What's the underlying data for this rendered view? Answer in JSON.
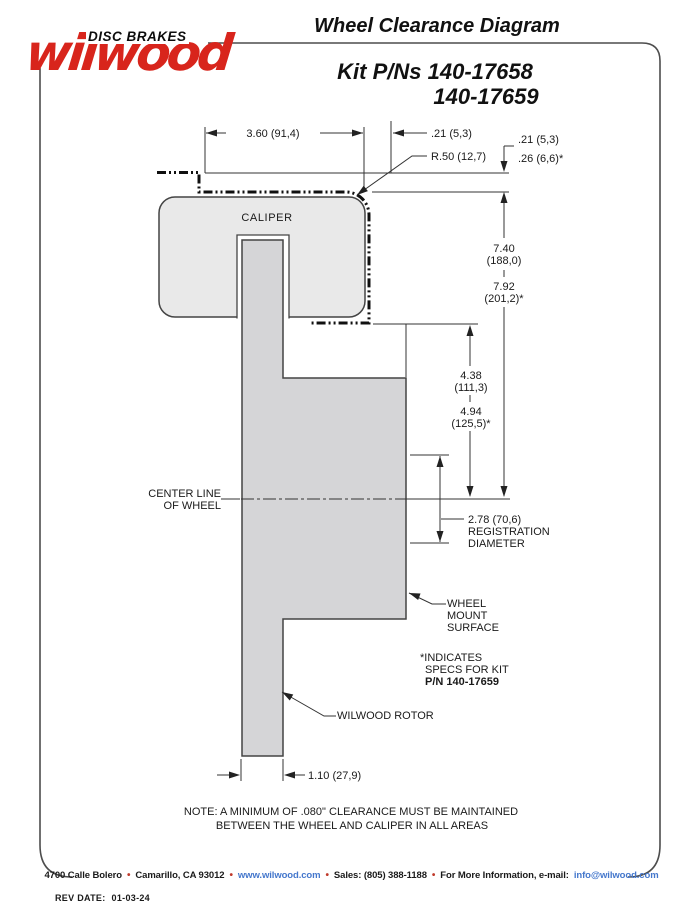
{
  "logo": {
    "brand": "wilwood",
    "tagline": "DISC BRAKES"
  },
  "header": {
    "title": "Wheel Clearance Diagram",
    "kit_line1": "Kit P/Ns 140-17658",
    "kit_line2": "140-17659"
  },
  "diagram": {
    "caliper_label": "CALIPER",
    "centerline_label_1": "CENTER LINE",
    "centerline_label_2": "OF WHEEL",
    "rotor_label": "WILWOOD ROTOR",
    "wheel_mount_label_1": "WHEEL",
    "wheel_mount_label_2": "MOUNT",
    "wheel_mount_label_3": "SURFACE",
    "registration_label_1": "2.78 (70,6)",
    "registration_label_2": "REGISTRATION",
    "registration_label_3": "DIAMETER",
    "footnote_1": "*INDICATES",
    "footnote_2": "SPECS FOR KIT",
    "footnote_3": "P/N 140-17659",
    "dims": {
      "caliper_width": "3.60 (91,4)",
      "corner_offset": ".21 (5,3)",
      "corner_radius": "R.50 (12,7)",
      "lip_gap_std": ".21 (5,3)",
      "lip_gap_kit": ".26 (6,6)*",
      "outer_radius_std": "7.40",
      "outer_radius_std_mm": "(188,0)",
      "outer_radius_kit": "7.92",
      "outer_radius_kit_mm": "(201,2)*",
      "inner_radius_std": "4.38",
      "inner_radius_std_mm": "(111,3)",
      "inner_radius_kit": "4.94",
      "inner_radius_kit_mm": "(125,5)*",
      "rotor_thickness": "1.10 (27,9)"
    }
  },
  "note": {
    "line1": "NOTE: A MINIMUM OF .080\" CLEARANCE MUST BE MAINTAINED",
    "line2": "BETWEEN THE WHEEL AND CALIPER IN ALL AREAS"
  },
  "footer": {
    "address": "4700 Calle Bolero",
    "city": "Camarillo, CA 93012",
    "web": "www.wilwood.com",
    "sales": "Sales: (805) 388-1188",
    "info": "For More Information, e-mail:",
    "email": "info@wilwood.com",
    "separator": "•"
  },
  "rev": {
    "label": "REV DATE:",
    "value": "01-03-24"
  },
  "colors": {
    "brand_red": "#d8251c",
    "link_blue": "#4477cc",
    "bullet_red": "#c03a2b",
    "caliper_fill": "#e9e9e9",
    "rotor_fill": "#d5d5d7",
    "line_dark": "#333333"
  }
}
